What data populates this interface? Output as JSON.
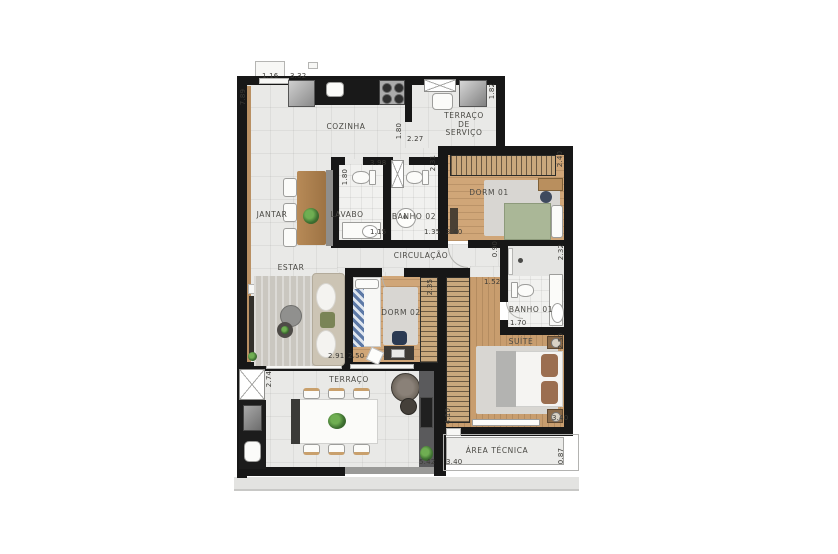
{
  "page_title": "Apartment floor plan",
  "rooms": {
    "cozinha": "COZINHA",
    "servico": "TERRAÇO\nDE\nSERVIÇO",
    "jantar": "JANTAR",
    "lavabo": "LAVABO",
    "banho02": "BANHO 02",
    "dorm01": "DORM 01",
    "circulacao": "CIRCULAÇÃO",
    "estar": "ESTAR",
    "dorm02": "DORM 02",
    "banho01": "BANHO 01",
    "suite": "SUÍTE",
    "terraco": "TERRAÇO",
    "area_tecnica": "ÁREA TÉCNICA"
  },
  "dimensions": {
    "d0": "7.89",
    "d1": "1.16",
    "d2": "3.32",
    "d3": "1.82",
    "d4": "1.80",
    "d5": "2.27",
    "d6": "3.98",
    "d7": "1.80",
    "d8": "2.31",
    "d9": "1.15",
    "d10": "1.35",
    "d11": "3.40",
    "d12": "2.40",
    "d13": "0.90",
    "d14": "2.32",
    "d15": "2.35",
    "d16": "1.52",
    "d17": "1.70",
    "d18": "2.50",
    "d19": "2.91",
    "d20": "2.50",
    "d21": "2.74",
    "d22": "5.42",
    "d23": "3.40",
    "d24": "3.40",
    "d25": "4.10",
    "d26": "0.87"
  },
  "colors": {
    "wall": "#171717",
    "tile_floor": "#e9e9e7",
    "wood_floor": "#d0a678",
    "counter_black": "#191919",
    "plant_green": "#3e7031",
    "bed_dorm01": "#aab797",
    "bed_dorm02_accent": "#5d79a6",
    "suite_pillow": "#9b6e50",
    "label_text": "#4a4944",
    "dimension_text": "#3b3a36"
  }
}
